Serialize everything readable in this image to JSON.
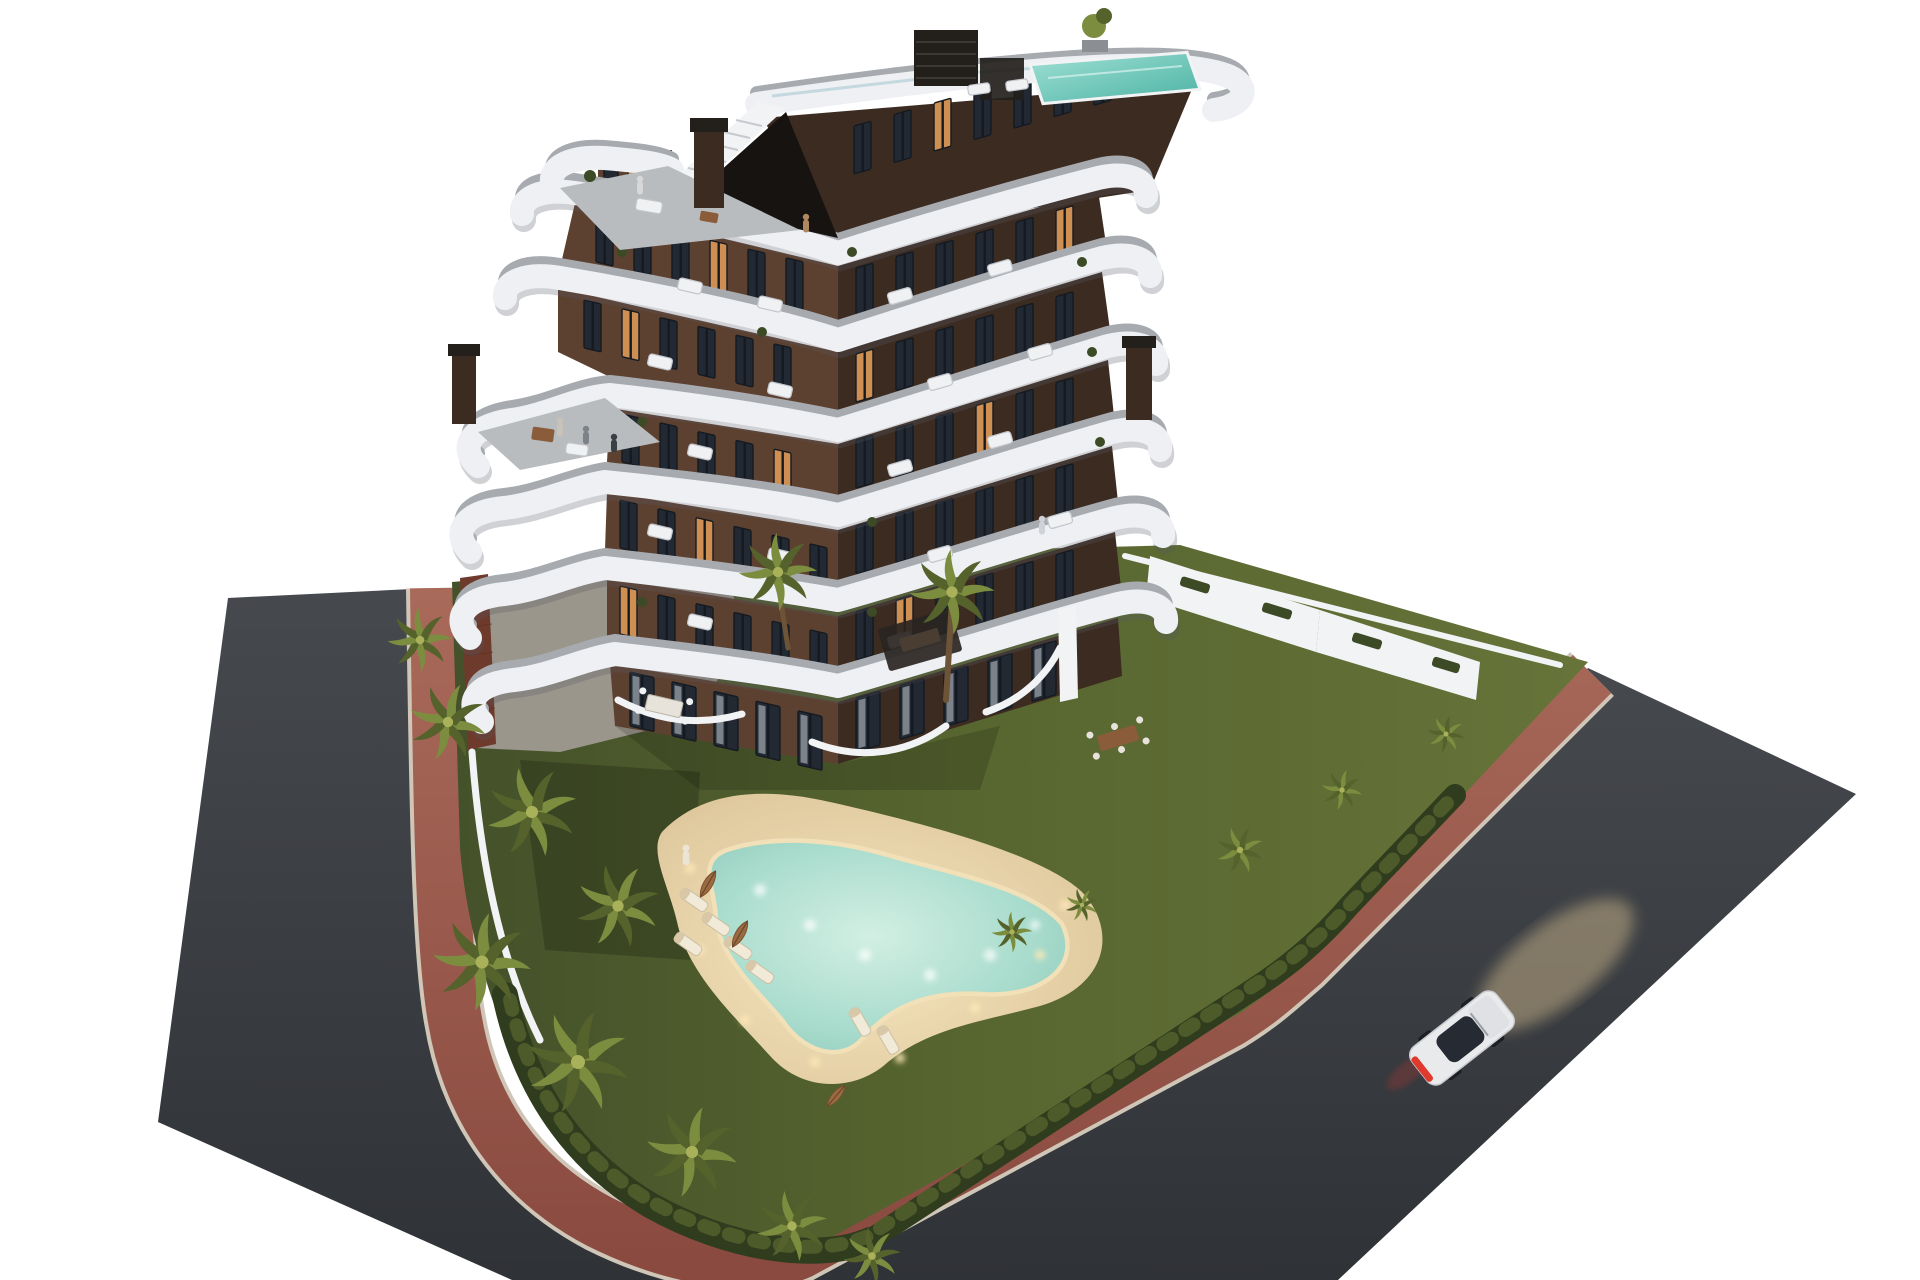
{
  "scene": {
    "description": "Dusk 3D architectural rendering of a modern curved-balcony apartment building on a corner plot with landscaped garden, lagoon pool and surrounding roads",
    "background_color": "#ffffff",
    "time_of_day": "dusk, interior and pool lights on",
    "palette": {
      "sky": "#ffffff",
      "asphalt": "#43464b",
      "asphalt_dark": "#2f3236",
      "walkway_top": "#a96a5a",
      "walkway_bottom": "#8a4a40",
      "curb": "#cfc6b8",
      "lawn": "#5a692f",
      "lawn_shadow": "#3e4b26",
      "hedge": "#2f3d1e",
      "palm_light": "#a9b25a",
      "palm_mid": "#7c8d3f",
      "palm_dark": "#55622c",
      "trunk": "#6e5436",
      "soil": "#6b5d46",
      "pool_water": "#a9dccd",
      "pool_water_light": "#d2efe3",
      "pool_rim": "#f1e0b8",
      "deck": "#e0c89d",
      "deck_glow": "#f6e6bf",
      "band_white": "#eef0f3",
      "terrace_gray": "#a7abb0",
      "plaza_gray": "#9b968c",
      "facade_left": "#5d4130",
      "facade_right": "#3c2b21",
      "brick": "#6e3a2c",
      "window_dark": "#222933",
      "window_lit": "#d08f52",
      "frame": "#141a21",
      "curtain": "#9aa0a8",
      "wall_white": "#f2f3f5",
      "glass_rail": "#bcd3da",
      "car_body": "#e9eaec",
      "car_glass": "#262b33",
      "taillight": "#e0392e",
      "headlight_glow": "#f7d9a0",
      "rooftop_pool": "#6fc7bd",
      "slat_dark": "#23201c",
      "wood": "#8a5c3a"
    },
    "building": {
      "style": "stepped chevron block, dark brown facade, white wavy wrap-around balcony bands",
      "visible_floors": 7,
      "balcony_bands": 7,
      "rooftop": [
        "plunge pool",
        "glass railing",
        "louver feature wall",
        "access staircase",
        "planter tree"
      ],
      "chimneys": 3,
      "lit_windows": true
    },
    "garden": {
      "pool": {
        "shape": "freeform lagoon",
        "underwater_lights": true,
        "sand_deck": true
      },
      "sun_loungers": 7,
      "parasols": 3,
      "palm_trees": 16,
      "central_palm_island": true,
      "hedge_perimeter": true,
      "ground_floor_terraces": [
        "dining tables",
        "sofas",
        "white curved privacy walls"
      ]
    },
    "streets": {
      "left_road": "dark asphalt",
      "main_road": "dark asphalt, lower right",
      "pedestrian_path": "red-brown walkway wrapping the plot",
      "perimeter_walls": "white with planters"
    },
    "vehicle": {
      "type": "white coupe",
      "state": "driving, headlights and taillights on",
      "location": "main road lower right"
    },
    "people_visible": 7
  }
}
